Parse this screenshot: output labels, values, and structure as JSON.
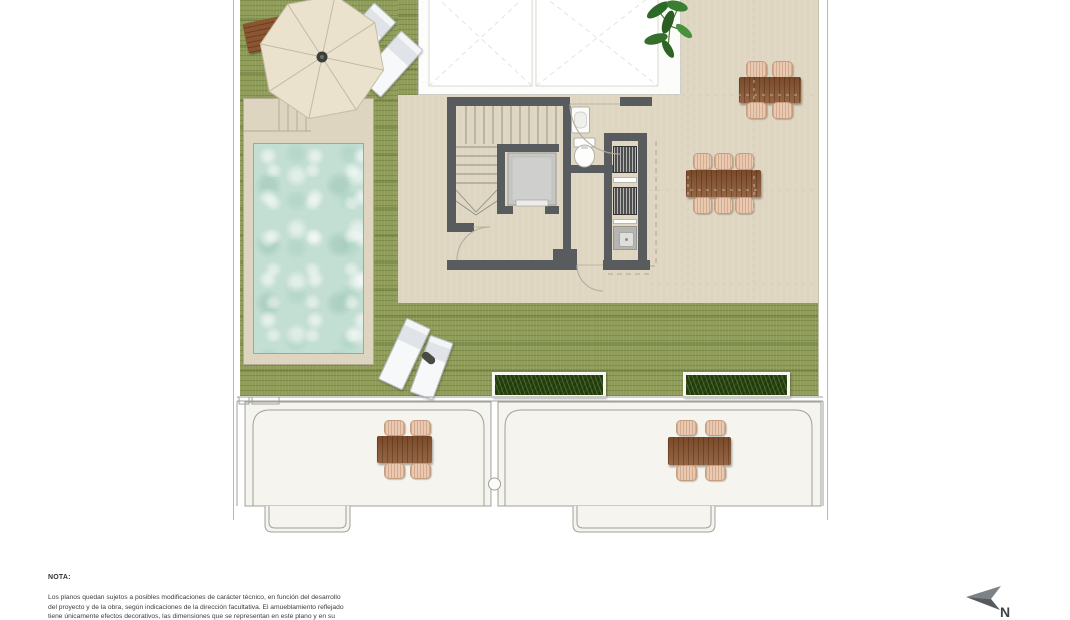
{
  "note": {
    "heading": "NOTA:",
    "lines": [
      "Los planos quedan sujetos a posibles modificaciones de carácter técnico, en función del desarrollo",
      "del proyecto y de la obra, según indicaciones de la dirección facultativa. El amueblamiento reflejado",
      "tiene únicamente efectos decorativos, las dimensiones que se representan en este plano y en su"
    ]
  },
  "compass": {
    "label": "N"
  },
  "plan": {
    "type": "roof-terrace-floor-plan",
    "colors": {
      "grass": "#8e9c57",
      "terrace_tile": "#ded6c1",
      "wall": "#595c5e",
      "pool_water": "#c3ded3",
      "pool_deck": "#ddd5bf",
      "wood_furniture": "#8a5530",
      "chair": "#e9c9b1",
      "planter_foliage": "#24390f",
      "lower_room_floor": "#f5f4ee",
      "outline": "#9d9d97"
    },
    "features": [
      "pool",
      "parasol",
      "wood-bench",
      "sun-loungers",
      "dining-tables",
      "planters",
      "staircase",
      "elevator",
      "toilet",
      "sink",
      "ventilation-units",
      "skylights",
      "lower-terraces",
      "plant"
    ]
  }
}
